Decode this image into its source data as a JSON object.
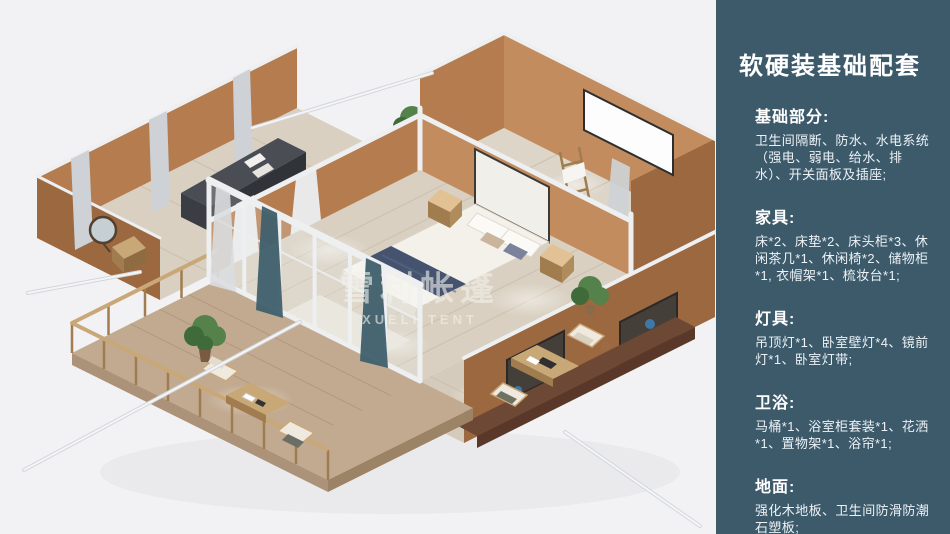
{
  "palette": {
    "bg": "#f2f2f4",
    "sidebar_bg": "#3d5a6b",
    "wall": "#b57c4f",
    "wall_light": "#c28c5e",
    "wall_dark": "#9c6840",
    "floor": "#d9d0c1",
    "floor_line": "#c8bcaa",
    "deck": "#c2aa90",
    "frame": "#edeff1",
    "curtain": "#ced2d6",
    "teal_curtain": "#41616d",
    "bed": "#f3f1ea",
    "navy": "#45536f",
    "wood": "#c9a878",
    "wood_dark": "#a07c4e",
    "furniture_dark": "#4a4e54",
    "sideboard": "#6d4834",
    "plant": "#55824a"
  },
  "render": {
    "watermark_cn": "雪利帐篷",
    "watermark_en": "XUELI TENT"
  },
  "sidebar": {
    "title": "软硬装基础配套",
    "sections": [
      {
        "heading": "基础部分:",
        "body": "卫生间隔断、防水、水电系统（强电、弱电、给水、排水）、开关面板及插座;"
      },
      {
        "heading": "家具:",
        "body": "床*2、床垫*2、床头柜*3、休闲茶几*1、休闲椅*2、储物柜*1, 衣帽架*1、梳妆台*1;"
      },
      {
        "heading": "灯具:",
        "body": "吊顶灯*1、卧室壁灯*4、镜前灯*1、卧室灯带;"
      },
      {
        "heading": "卫浴:",
        "body": "马桶*1、浴室柜套装*1、花洒*1、置物架*1、浴帘*1;"
      },
      {
        "heading": "地面:",
        "body": "强化木地板、卫生间防滑防潮石塑板;"
      }
    ]
  }
}
